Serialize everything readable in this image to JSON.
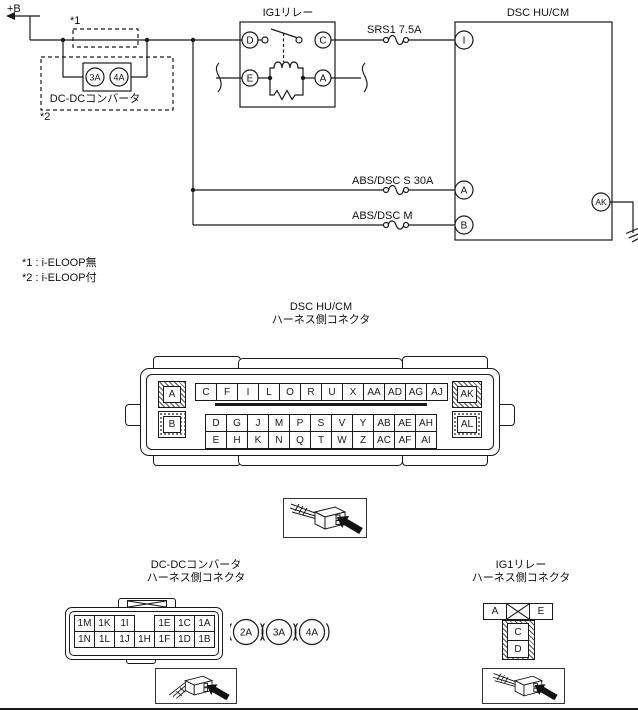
{
  "diagram": {
    "power_label": "+B",
    "relay": {
      "title": "IG1リレー",
      "terminals": {
        "d": "D",
        "c": "C",
        "e": "E",
        "a": "A"
      }
    },
    "fuses": {
      "srs1": "SRS1 7.5A",
      "abs_dsc_s": "ABS/DSC S 30A",
      "abs_dsc_m": "ABS/DSC M"
    },
    "dcdc": {
      "label": "DC-DCコンバータ",
      "fuse_3a": "3A",
      "fuse_4a": "4A",
      "ref1": "*1",
      "ref2": "*2"
    },
    "module": {
      "title": "DSC HU/CM",
      "terminals": {
        "i": "I",
        "a": "A",
        "b": "B",
        "ak": "AK"
      }
    },
    "notes": [
      "*1 : i-ELOOP無",
      "*2 : i-ELOOP付"
    ]
  },
  "connectors": {
    "dsc": {
      "title_line1": "DSC HU/CM",
      "title_line2": "ハーネス側コネクタ",
      "corner_pins": {
        "a": "A",
        "b": "B",
        "ak": "AK",
        "al": "AL"
      },
      "row_top": [
        "C",
        "F",
        "I",
        "L",
        "O",
        "R",
        "U",
        "X",
        "AA",
        "AD",
        "AG",
        "AJ"
      ],
      "row_mid": [
        "D",
        "G",
        "J",
        "M",
        "P",
        "S",
        "V",
        "Y",
        "AB",
        "AE",
        "AH"
      ],
      "row_bot": [
        "E",
        "H",
        "K",
        "N",
        "Q",
        "T",
        "W",
        "Z",
        "AC",
        "AF",
        "AI"
      ]
    },
    "dcdc": {
      "title_line1": "DC-DCコンバータ",
      "title_line2": "ハーネス側コネクタ",
      "row_top": [
        "1M",
        "1K",
        "1I",
        "",
        "1E",
        "1C",
        "1A"
      ],
      "row_bot": [
        "1N",
        "1L",
        "1J",
        "1H",
        "1F",
        "1D",
        "1B"
      ],
      "fuses": [
        "2A",
        "3A",
        "4A"
      ]
    },
    "ig1": {
      "title_line1": "IG1リレー",
      "title_line2": "ハーネス側コネクタ",
      "pin_a": "A",
      "pin_e": "E",
      "pin_c": "C",
      "pin_d": "D"
    }
  },
  "icons": {
    "plug_photo": "connector-plug-with-arrow",
    "ground": "chassis-ground",
    "power_arrow": "left-arrow-to-plus-b"
  },
  "colors": {
    "line": "#1a1a1a",
    "background": "#ffffff"
  }
}
